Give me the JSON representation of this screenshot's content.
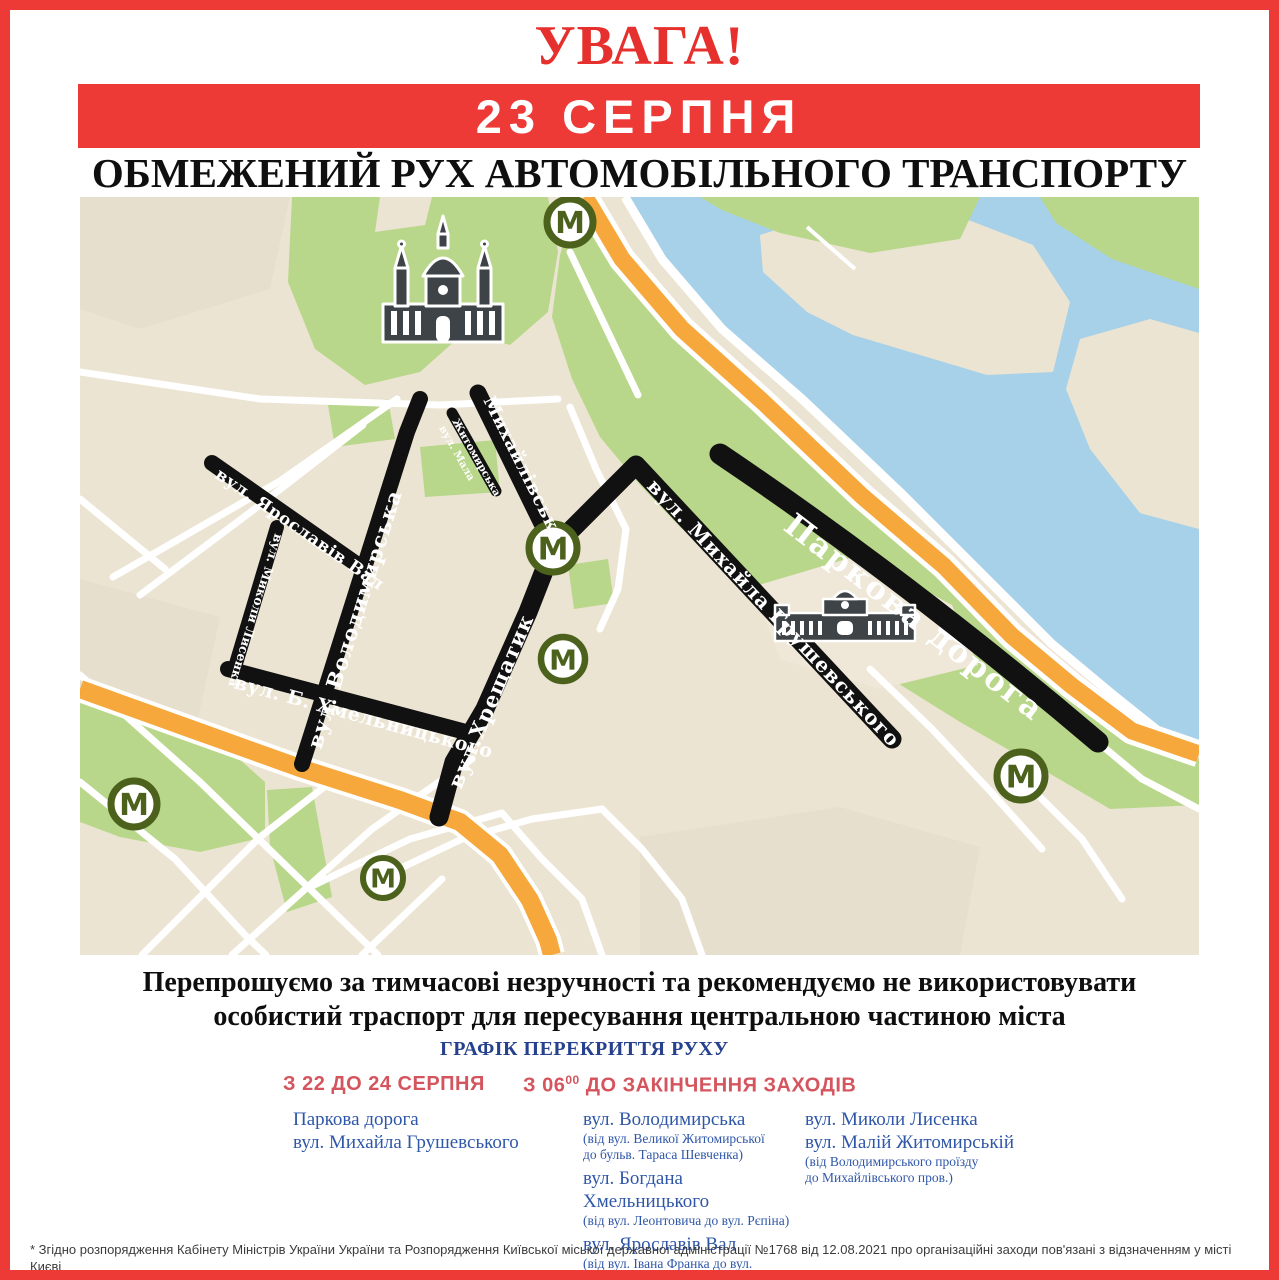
{
  "colors": {
    "frame_red": "#ee3a36",
    "attention_red": "#e5302d",
    "schedule_navy": "#26418d",
    "schedule_red": "#d4555e",
    "street_blue": "#2f57a8",
    "map_beige": "#ece4d2",
    "map_green": "#b8d78a",
    "map_water": "#a7d1e8",
    "map_orange": "#f7a83c",
    "metro_green": "#4c621c"
  },
  "header": {
    "attention": "УВАГА!",
    "date_banner": "23 СЕРПНЯ",
    "title": "ОБМЕЖЕНИЙ РУХ АВТОМОБІЛЬНОГО ТРАНСПОРТУ"
  },
  "map": {
    "metro_letter": "М",
    "labels": {
      "yaroslaviv_val": "вул. Ярославів Вал",
      "mykoly_lysenka": "вул. Миколи Лисенка",
      "volodymyrska": "вул. Володимирська",
      "b_khmelnytskoho": "вул. Б. Хмельницького",
      "khreshchatyk": "вул.Хрещатик",
      "mykhailivska": "Михайлівська",
      "mala_zhytomyrska_line1": "вул. Мала",
      "mala_zhytomyrska_line2": "Житомирська",
      "hrushevskoho": "вул. Михайла Грушевського",
      "parkova_doroha": "Паркова дорога"
    }
  },
  "apology": {
    "text": "Перепрошуємо за тимчасові незручності та рекомендуємо не використовувати\nособистий траспорт для пересування центральною частиною міста"
  },
  "schedule": {
    "title": "ГРАФІК ПЕРЕКРИТТЯ РУХУ",
    "heading_dates": "З 22 ДО 24 СЕРПНЯ",
    "heading_time_prefix": "З 06",
    "heading_time_sup": "00",
    "heading_time_suffix": " ДО ЗАКІНЧЕННЯ ЗАХОДІВ",
    "col1": {
      "items": [
        {
          "name": "Паркова дорога",
          "note": ""
        },
        {
          "name": "вул. Михайла Грушевського",
          "note": ""
        }
      ]
    },
    "col2": {
      "items": [
        {
          "name": "вул. Володимирська",
          "note": "(від вул. Великої Житомирської\nдо бульв. Тараса Шевченка)"
        },
        {
          "name": "вул. Богдана Хмельницького",
          "note": "(від вул. Леонтовича до вул. Рєпіна)"
        },
        {
          "name": "вул. Ярославів Вал",
          "note": "(від вул. Івана Франка до вул.\nВолодимирської)"
        }
      ]
    },
    "col3": {
      "items": [
        {
          "name": "вул. Миколи Лисенка",
          "note": ""
        },
        {
          "name": "вул. Малій Житомирській",
          "note": "(від Володимирського проїзду\nдо Михайлівського пров.)"
        }
      ]
    }
  },
  "footnote": {
    "text": "* Згідно розпорядження Кабінету Міністрів України України та Розпорядження Київської міської державної адміністрації №1768 від 12.08.2021 про організаційні заходи пов'язані з відзначенням у місті Києві\nДня державного прапора України та 30 річниці Незалежності України"
  }
}
